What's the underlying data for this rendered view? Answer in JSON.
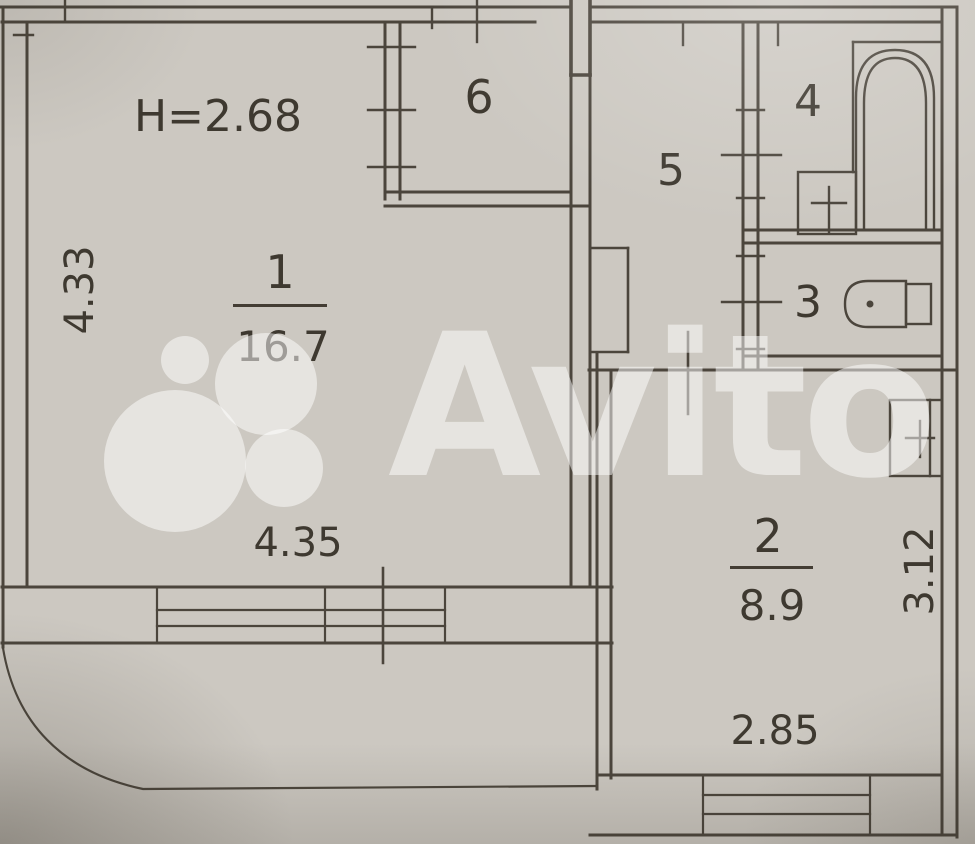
{
  "watermark": {
    "brand": "Avito",
    "color": "#ffffff"
  },
  "plan": {
    "ceiling_height_label": "H=2.68",
    "rooms": [
      {
        "number": "1",
        "area": "16.7",
        "type": "living-room"
      },
      {
        "number": "2",
        "area": "8.9",
        "type": "kitchen"
      },
      {
        "number": "3",
        "type": "wc"
      },
      {
        "number": "4",
        "type": "bathroom"
      },
      {
        "number": "5",
        "type": "hallway"
      },
      {
        "number": "6",
        "type": "closet"
      }
    ],
    "dimensions": [
      {
        "value": "4.33",
        "edge": "left-wall"
      },
      {
        "value": "4.35",
        "edge": "room1-bottom"
      },
      {
        "value": "3.12",
        "edge": "right-wall"
      },
      {
        "value": "2.85",
        "edge": "room2-bottom"
      }
    ],
    "fixtures": [
      "bathtub-icon",
      "bathroom-sink-icon",
      "toilet-icon",
      "kitchen-sink-icon"
    ],
    "colors": {
      "paper": "#ccc8c1",
      "line": "#4b453c",
      "text": "#3e3930"
    }
  }
}
